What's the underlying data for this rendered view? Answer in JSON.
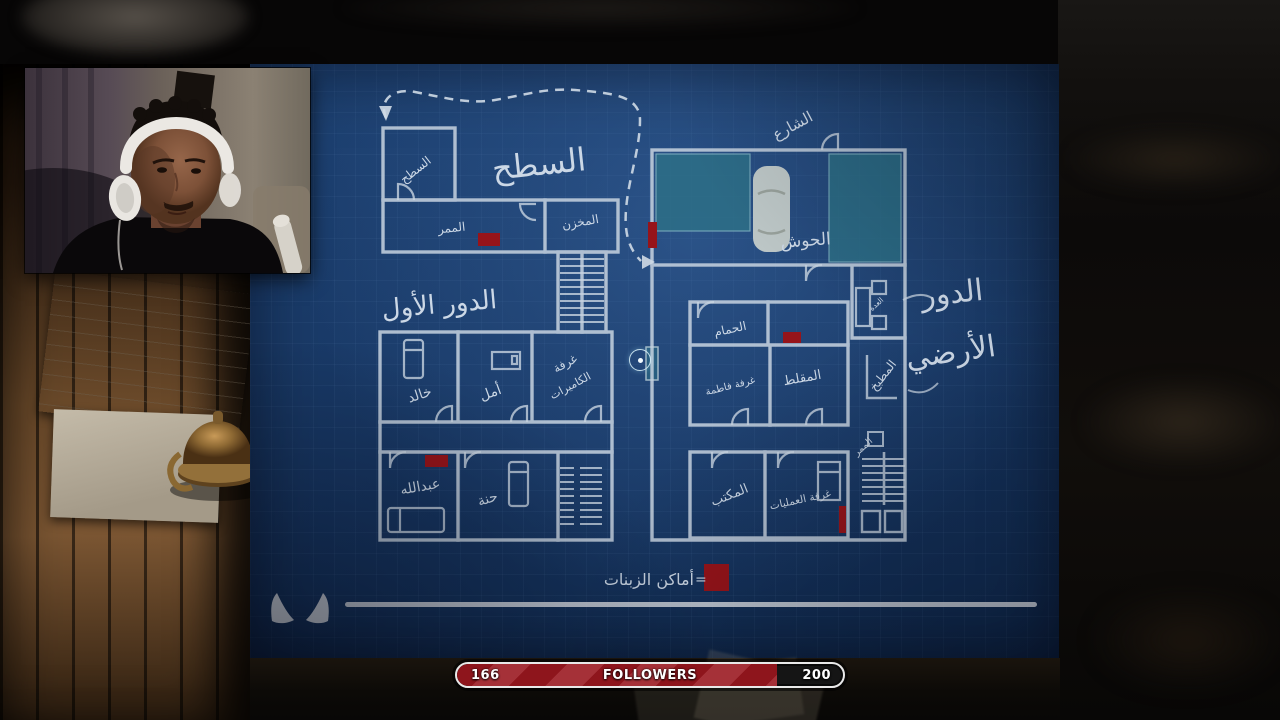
{
  "hud": {
    "followers": {
      "current": "166",
      "label": "FOLLOWERS",
      "max": "200",
      "percent": 83
    }
  },
  "blueprint": {
    "titles": {
      "roof": "السطح",
      "first_floor": "الدور الأول",
      "ground_floor_line1": "الدور",
      "ground_floor_line2": "الأرضي"
    },
    "outdoor": {
      "street": "الشارع",
      "courtyard": "الحوش"
    },
    "rooms": {
      "roof_access": "السطح",
      "corridor": "الممر",
      "storage": "المخزن",
      "khalid": "خالد",
      "amal": "أمل",
      "camera_room_line1": "غرفة",
      "camera_room_line2": "الكاميرات",
      "abdullah": "عبدالله",
      "hanna": "حنة",
      "bathroom": "الحمام",
      "fatima_room": "غرفة فاطمة",
      "majlis": "المقلط",
      "kitchen": "المطبخ",
      "utility": "العدة",
      "hallway": "الممر",
      "office": "المكتب",
      "operations_room": "غرفة العمليات"
    },
    "legend": {
      "equals": "=",
      "label": "أماكن الزبنات"
    },
    "colors": {
      "paper_blue": "#16355f",
      "ink": "#c8d4e1",
      "marker_red": "#96141a",
      "courtyard_teal": "#2d7187"
    }
  }
}
